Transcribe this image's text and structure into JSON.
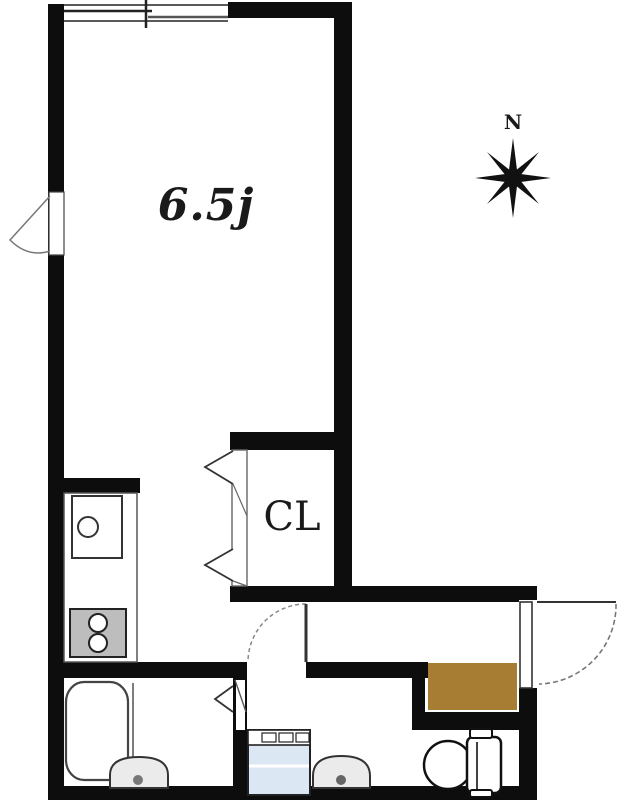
{
  "floorplan": {
    "labels": {
      "room": "6.5j",
      "closet": "CL",
      "compass_north": "N"
    },
    "colors": {
      "wall": "#0d0d0d",
      "genkan_mat": "#a67d33",
      "washer_body": "#dbe7f3",
      "fixture_gray": "#bdbdbd",
      "basin_gray": "#ebebeb",
      "line": "#333333"
    },
    "fixtures": [
      "sliding-window",
      "swing-door-left",
      "closet-bifold-door",
      "hall-swing-door",
      "bathroom-folding-door",
      "entrance-swing-door",
      "kitchen-sink",
      "gas-stove",
      "kitchen-counter",
      "bathtub",
      "bathroom-basin",
      "washing-machine",
      "washroom-basin",
      "toilet",
      "entrance-mat",
      "compass-rose"
    ]
  }
}
